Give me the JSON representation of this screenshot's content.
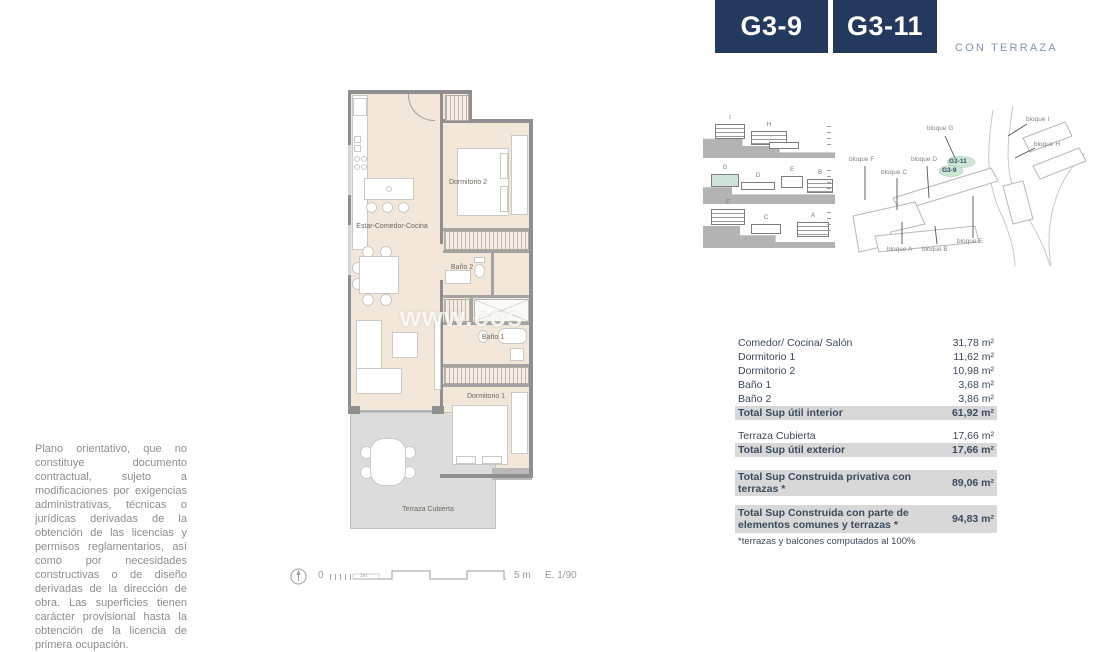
{
  "header": {
    "units": [
      {
        "code": "G3-9"
      },
      {
        "code": "G3-11"
      }
    ],
    "subtitle": "CON TERRAZA"
  },
  "plan": {
    "room_labels": {
      "living": "Estar-Comedor-Cocina",
      "bedroom2": "Dormitorio 2",
      "bath2": "Baño 2",
      "bath1": "Baño 1",
      "bedroom1": "Dormitorio 1",
      "terrace": "Terraza Cubierta"
    },
    "watermark": "www.cos"
  },
  "scale_bar": {
    "zero": "0",
    "one_meter": "1m",
    "five_meters": "5 m",
    "scale_ratio": "E. 1/90"
  },
  "sections": {
    "row1": {
      "b1": "I",
      "b2": "H"
    },
    "row2": {
      "b1": "G",
      "b2": "D",
      "b3": "E",
      "b4": "B"
    },
    "row3": {
      "b1": "F",
      "b2": "C",
      "b3": "A"
    }
  },
  "site_map": {
    "labels": {
      "g": "bloque G",
      "i": "bloque I",
      "h": "bloque H",
      "f": "bloque F",
      "d": "bloque D",
      "c": "bloque C",
      "a": "bloque A",
      "b": "bloque B",
      "e": "bloque E"
    },
    "unit_tags": {
      "top": "G3-11",
      "bottom": "G3-9"
    }
  },
  "areas_table": {
    "rows": [
      {
        "label": "Comedor/ Cocina/ Salón",
        "value": "31,78 m²"
      },
      {
        "label": "Dormitorio 1",
        "value": "11,62 m²"
      },
      {
        "label": "Dormitorio 2",
        "value": "10,98 m²"
      },
      {
        "label": "Baño 1",
        "value": "3,68 m²"
      },
      {
        "label": "Baño 2",
        "value": "3,86 m²"
      },
      {
        "label": "Total Sup útil interior",
        "value": "61,92 m²"
      },
      {
        "label": "Terraza Cubierta",
        "value": "17,66 m²"
      },
      {
        "label": "Total Sup útil exterior",
        "value": "17,66 m²"
      },
      {
        "label": "Total Sup Construida privativa con terrazas *",
        "value": "89,06 m²"
      },
      {
        "label": "Total Sup Construida con parte de elementos comunes y terrazas *",
        "value": "94,83 m²"
      }
    ],
    "footnote": "*terrazas y balcones computados al 100%"
  },
  "disclaimer": "Plano orientativo, que no constituye documento contractual, sujeto a modificaciones por exigencias administrativas, técnicas o jurídicas derivadas de la obtención de las licencias y permisos reglamentarios, así como por necesidades constructivas o de diseño derivadas de la dirección de obra. Las superficies tienen carácter provisional hasta la obtención de la licencia de primera ocupación.",
  "colors": {
    "accent_navy": "#24395e",
    "subtitle_blue": "#8296ac",
    "highlight_gray": "#d8d8d8",
    "plan_beige": "#f2e7d8",
    "terrace_gray": "#dcdcdc",
    "unit_highlight_green": "#cfe5d4"
  }
}
